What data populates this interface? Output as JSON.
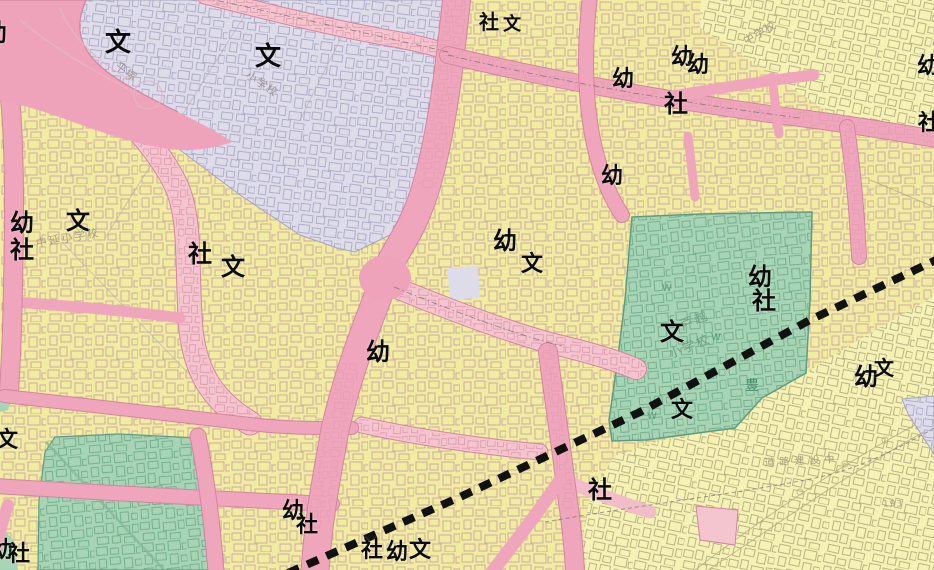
{
  "map": {
    "description": "Japanese city planning / zoning map tile (urban district around Togoshi, Shinagawa) with zoning colors, road corridors, school and shrine map symbols, and a bold dashed planned-line crossing diagonally",
    "legend_colors": {
      "residential_yellow": "#F1EC9F",
      "pale_yellow_adjacent_district": "#F6F2B5",
      "road_commercial_pink": "#EFA6BC",
      "light_pink_corridor": "#F5C5CF",
      "intersection_pink": "#EFA3BA",
      "institutional_lavender": "#DFDCEA",
      "school_park_green": "#A6D4B4",
      "building_outline_on_yellow": "#C59FA8",
      "building_outline_on_lavender": "#A9A9C4",
      "building_outline_on_green": "#72AC8E",
      "building_outline_pale_district": "#B2AD7F",
      "road_edge_line": "#D4849E",
      "dashed_route_line": "#111111"
    },
    "symbol_legend": {
      "文": "school",
      "幼": "kindergarten",
      "社": "shrine"
    },
    "symbol_labels": [
      {
        "char": "幼",
        "x": -5,
        "y": 33,
        "fs": 24
      },
      {
        "char": "文",
        "x": 118,
        "y": 43,
        "fs": 26
      },
      {
        "char": "文",
        "x": 268,
        "y": 57,
        "fs": 26
      },
      {
        "char": "社",
        "x": 489,
        "y": 22,
        "fs": 20
      },
      {
        "char": "文",
        "x": 512,
        "y": 25,
        "fs": 18
      },
      {
        "char": "幼",
        "x": 682,
        "y": 58,
        "fs": 22
      },
      {
        "char": "幼",
        "x": 698,
        "y": 66,
        "fs": 22
      },
      {
        "char": "幼",
        "x": 623,
        "y": 80,
        "fs": 22
      },
      {
        "char": "社",
        "x": 676,
        "y": 104,
        "fs": 24
      },
      {
        "char": "幼",
        "x": 612,
        "y": 177,
        "fs": 22
      },
      {
        "char": "幼",
        "x": 928,
        "y": 67,
        "fs": 22
      },
      {
        "char": "社",
        "x": 929,
        "y": 124,
        "fs": 22
      },
      {
        "char": "幼",
        "x": 22,
        "y": 223,
        "fs": 24
      },
      {
        "char": "社",
        "x": 22,
        "y": 250,
        "fs": 24
      },
      {
        "char": "文",
        "x": 78,
        "y": 221,
        "fs": 24
      },
      {
        "char": "社",
        "x": 200,
        "y": 254,
        "fs": 24
      },
      {
        "char": "文",
        "x": 233,
        "y": 267,
        "fs": 24
      },
      {
        "char": "幼",
        "x": 505,
        "y": 241,
        "fs": 24
      },
      {
        "char": "文",
        "x": 532,
        "y": 265,
        "fs": 22
      },
      {
        "char": "幼",
        "x": 378,
        "y": 352,
        "fs": 24
      },
      {
        "char": "幼",
        "x": 760,
        "y": 277,
        "fs": 24
      },
      {
        "char": "社",
        "x": 764,
        "y": 301,
        "fs": 24
      },
      {
        "char": "文",
        "x": 672,
        "y": 332,
        "fs": 24
      },
      {
        "char": "文",
        "x": 682,
        "y": 411,
        "fs": 22
      },
      {
        "char": "幼",
        "x": 866,
        "y": 377,
        "fs": 24
      },
      {
        "char": "文",
        "x": 884,
        "y": 368,
        "fs": 20
      },
      {
        "char": "社",
        "x": 600,
        "y": 490,
        "fs": 24
      },
      {
        "char": "幼",
        "x": 293,
        "y": 512,
        "fs": 22
      },
      {
        "char": "社",
        "x": 307,
        "y": 526,
        "fs": 22
      },
      {
        "char": "社",
        "x": 372,
        "y": 551,
        "fs": 22
      },
      {
        "char": "幼",
        "x": 397,
        "y": 553,
        "fs": 22
      },
      {
        "char": "文",
        "x": 420,
        "y": 551,
        "fs": 22
      },
      {
        "char": "幼",
        "x": 2,
        "y": 551,
        "fs": 22
      },
      {
        "char": "社",
        "x": 19,
        "y": 555,
        "fs": 22
      },
      {
        "char": "文",
        "x": 7,
        "y": 441,
        "fs": 22
      }
    ],
    "basemap_labels": [
      {
        "text": "平塚",
        "x": 126,
        "y": 72,
        "fs": 11,
        "color": "#9b8f96",
        "rot": 38,
        "ls": 1
      },
      {
        "text": "小学校",
        "x": 262,
        "y": 84,
        "fs": 11,
        "color": "#9b8f96",
        "rot": 33,
        "ls": 1
      },
      {
        "text": "中学校",
        "x": 760,
        "y": 33,
        "fs": 11,
        "color": "#a39d7a",
        "rot": -30,
        "ls": 1
      },
      {
        "text": "中延小学校",
        "x": 68,
        "y": 238,
        "fs": 11,
        "color": "#a59a80",
        "rot": -10,
        "ls": 2
      },
      {
        "text": "戸越",
        "x": 695,
        "y": 321,
        "fs": 13,
        "color": "#6f9e85",
        "rot": -22,
        "ls": 2
      },
      {
        "text": "小学校",
        "x": 690,
        "y": 347,
        "fs": 13,
        "color": "#6f9e85",
        "rot": -22,
        "ls": 2
      },
      {
        "text": "豊",
        "x": 752,
        "y": 386,
        "fs": 14,
        "color": "#43896b",
        "rot": 0,
        "ls": 0
      },
      {
        "text": "道路建設中",
        "x": 802,
        "y": 462,
        "fs": 10,
        "color": "#a39d7a",
        "rot": -3,
        "ls": 5
      },
      {
        "text": "193",
        "x": 893,
        "y": 505,
        "fs": 9,
        "color": "#a39d7a",
        "rot": 0,
        "ls": 1
      },
      {
        "text": "W",
        "x": 667,
        "y": 289,
        "fs": 10,
        "color": "#5e9a7e",
        "rot": 0,
        "ls": 0
      },
      {
        "text": "W",
        "x": 716,
        "y": 338,
        "fs": 10,
        "color": "#5e9a7e",
        "rot": 0,
        "ls": 0
      },
      {
        "text": "W",
        "x": 652,
        "y": 417,
        "fs": 10,
        "color": "#5e9a7e",
        "rot": 0,
        "ls": 0
      }
    ]
  }
}
